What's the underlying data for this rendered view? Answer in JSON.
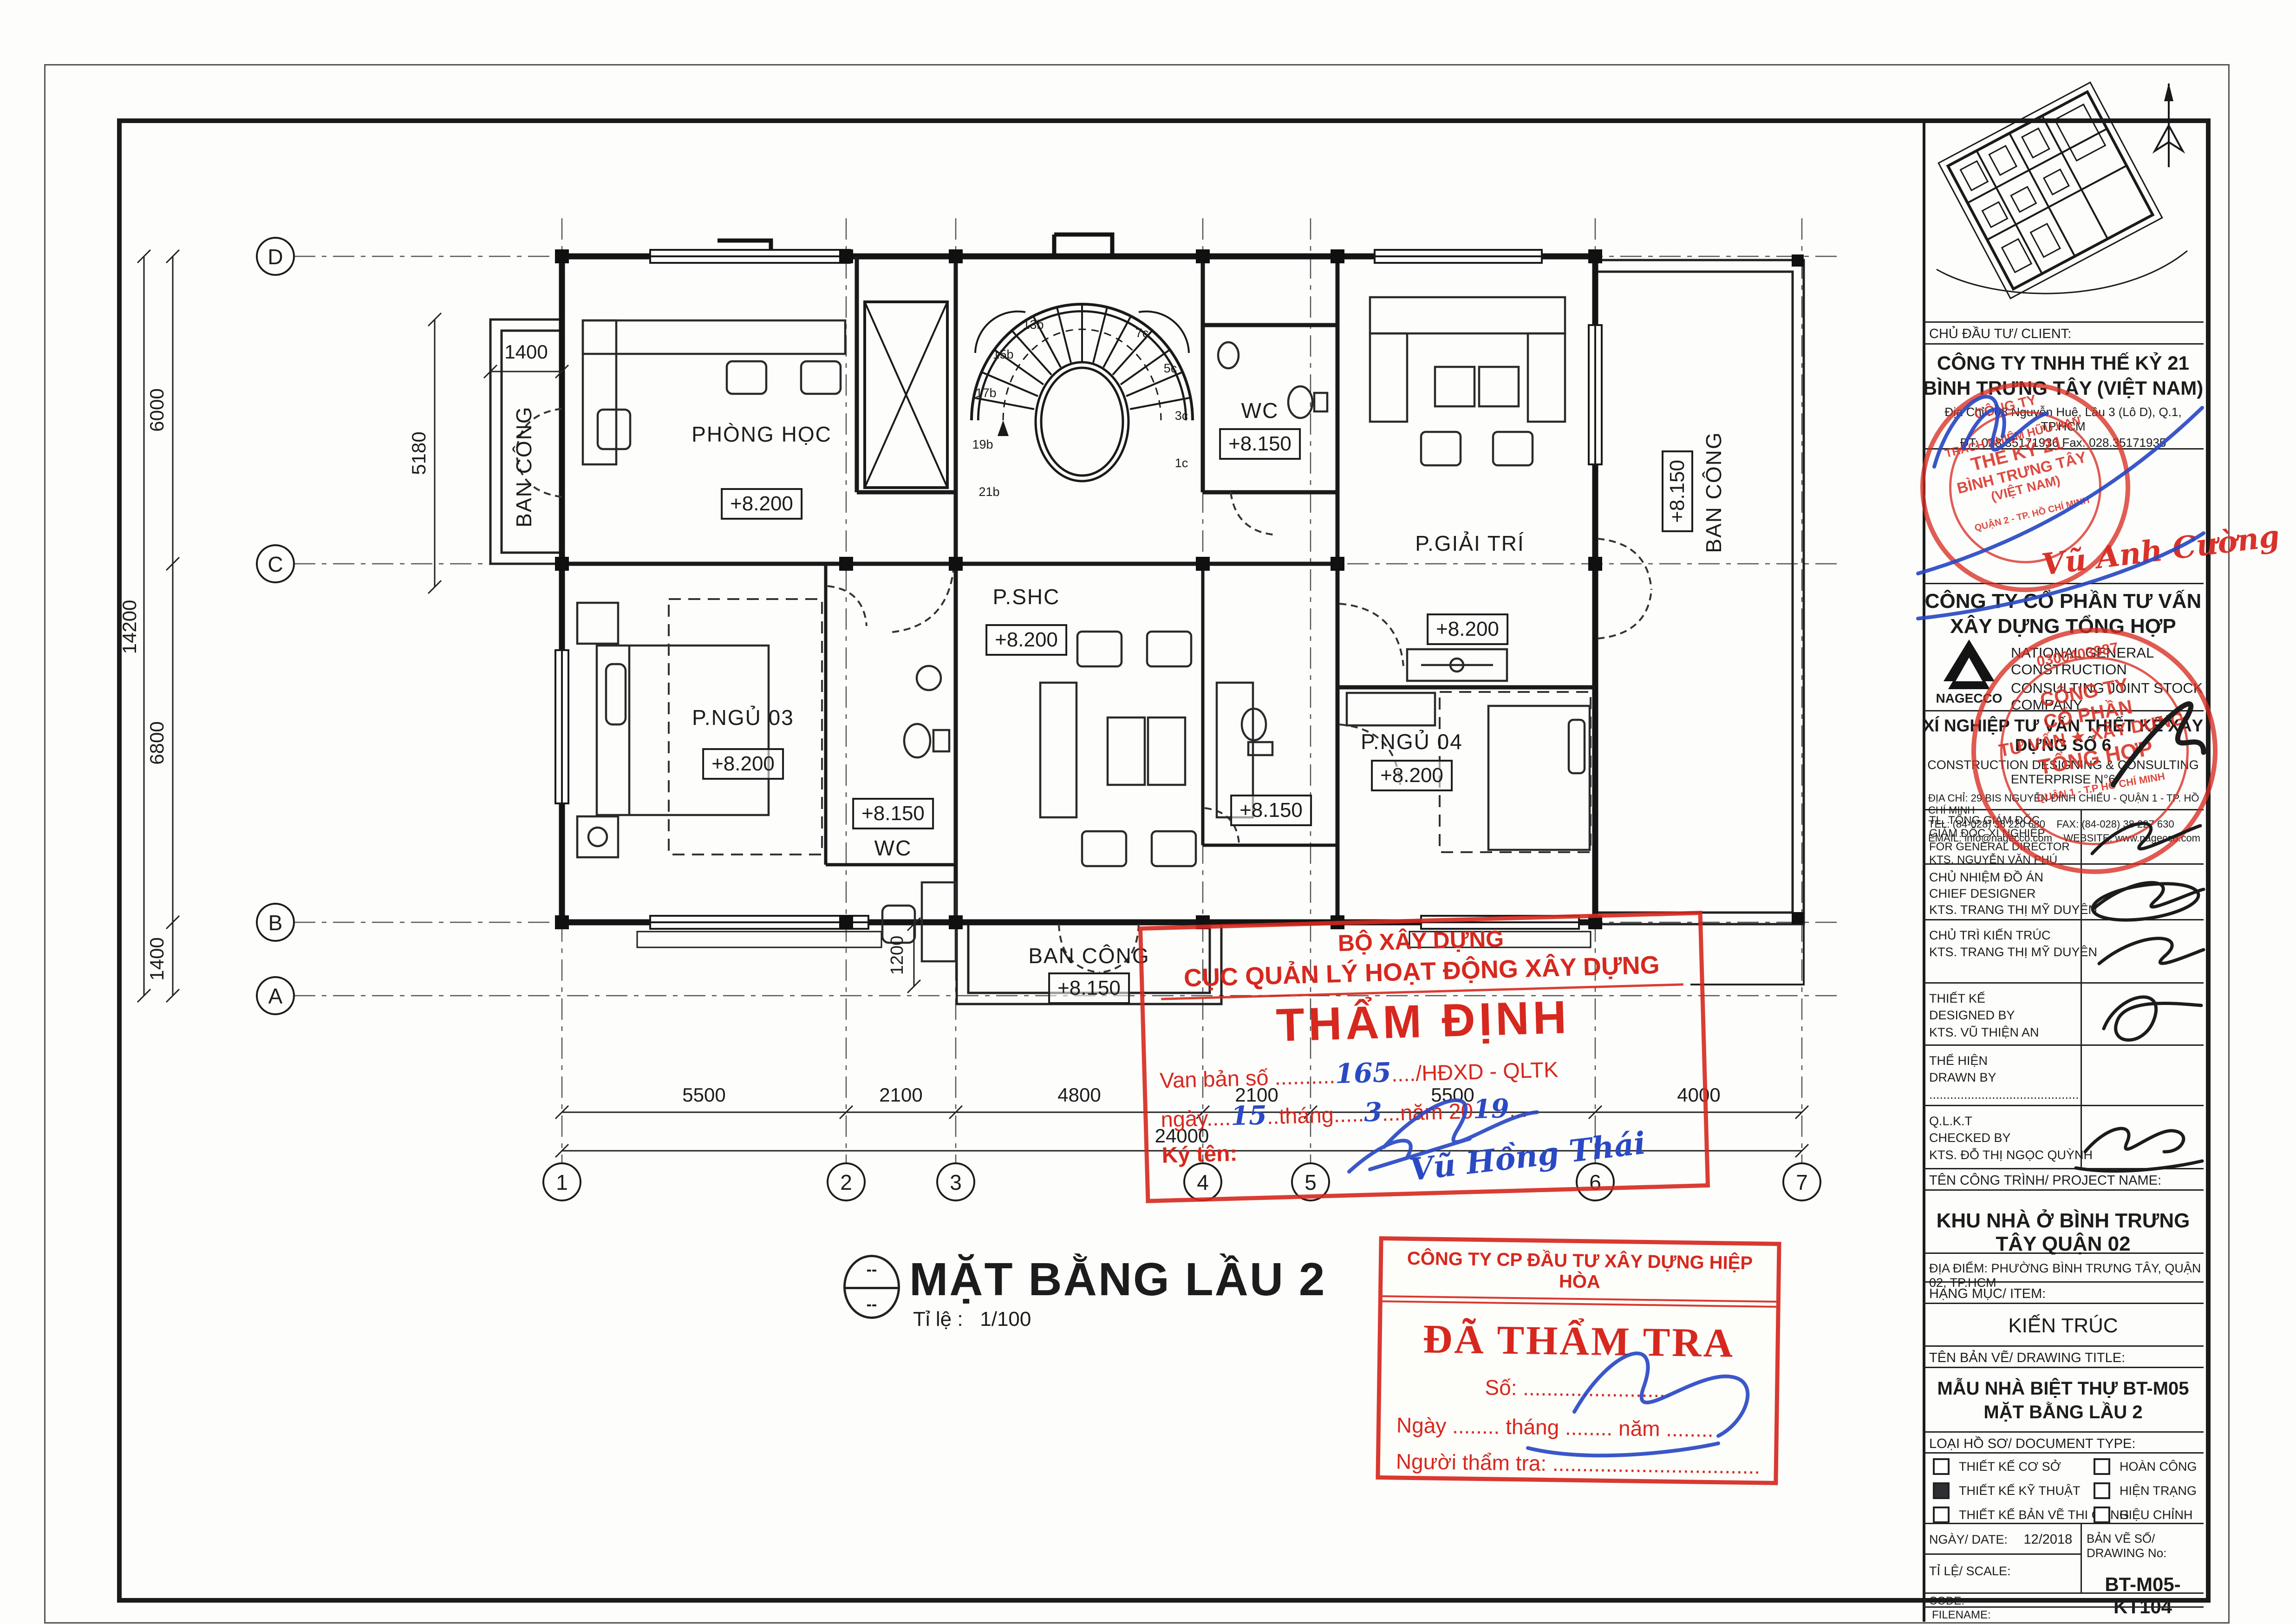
{
  "plan": {
    "title": "MẶT BẰNG LẦU 2",
    "scale_label": "Tỉ lệ :",
    "scale_value": "1/100",
    "fig_dash": "--",
    "grid_cols": [
      "1",
      "2",
      "3",
      "4",
      "5",
      "6",
      "7"
    ],
    "grid_rows": [
      "D",
      "C",
      "B",
      "A"
    ],
    "dims_bottom": [
      "5500",
      "2100",
      "4800",
      "2100",
      "5500",
      "4000"
    ],
    "dim_total_bottom": "24000",
    "dims_left": [
      "6000",
      "6800",
      "1400"
    ],
    "dim_total_left": "14200",
    "dim_balcony_w": "1400",
    "dim_balcony_h": "5180",
    "dim_porch": "1200",
    "rooms": {
      "phong_hoc": {
        "name": "PHÒNG HỌC",
        "level": "+8.200"
      },
      "giai_tri": {
        "name": "P.GIẢI TRÍ",
        "level": "+8.200"
      },
      "shc": {
        "name": "P.SHC",
        "level": "+8.200"
      },
      "ngu03": {
        "name": "P.NGỦ 03",
        "level": "+8.200"
      },
      "ngu04": {
        "name": "P.NGỦ 04",
        "level": "+8.200"
      },
      "wc_top": {
        "name": "WC",
        "level": "+8.150"
      },
      "wc_ngu03": {
        "name": "WC",
        "level": "+8.150"
      },
      "wc_ngu04": {
        "level": "+8.150"
      },
      "bc_left": {
        "name": "BAN CÔNG"
      },
      "bc_right": {
        "name": "BAN CÔNG",
        "level": "+8.150"
      },
      "bc_bottom": {
        "name": "BAN CÔNG",
        "level": "+8.150"
      }
    },
    "stair_labels": [
      "13b",
      "15b",
      "17b",
      "19b",
      "21b",
      "7c",
      "5c",
      "3c",
      "1c"
    ]
  },
  "stamps": {
    "tham_dinh": {
      "line1": "BỘ XÂY DỰNG",
      "line2": "CỤC QUẢN LÝ HOẠT ĐỘNG XÂY DỰNG",
      "title": "THẨM ĐỊNH",
      "doc_pre": "Van bản số ..........",
      "doc_no": "165",
      "doc_post": "..../HĐXD - QLTK",
      "date_pre": "ngày....",
      "date_day": "15",
      "date_mid": "..tháng.....",
      "date_month": "3",
      "date_post": "...năm 20",
      "date_year": "19",
      "date_end": "...",
      "sign_label": "Ký tên:",
      "signature": "Vũ Hồng Thái"
    },
    "da_tham_tra": {
      "company": "CÔNG TY CP ĐẦU TƯ XÂY DỰNG HIỆP HÒA",
      "title": "ĐÃ THẨM TRA",
      "so": "Số: .........................",
      "ngay": "Ngày ........ tháng ........ năm ........",
      "nguoi": "Người thẩm tra: ..................................."
    }
  },
  "titleblock": {
    "client_label": "CHỦ ĐẦU TƯ/ CLIENT:",
    "client_name1": "CÔNG TY TNHH THẾ KỶ 21",
    "client_name2": "BÌNH TRƯNG TÂY (VIỆT NAM)",
    "client_addr": "Địa Chỉ : 08 Nguyễn Huệ, Lầu 3 (Lô D), Q.1, TP.HCM",
    "client_tel": "ĐT: 028.35171936    Fax: 028.35171935",
    "sig_red": "Vũ Anh Cường",
    "consultant1": "CÔNG TY CỔ PHẦN TƯ VẤN",
    "consultant2": "XÂY DỰNG TỔNG HỢP",
    "consultant_en1": "NATIONAL GENERAL CONSTRUCTION",
    "consultant_en2": "CONSULTING JOINT STOCK COMPANY",
    "logo": "NAGECCO",
    "enterprise": "XÍ NGHIỆP TƯ VẤN THIẾT KẾ XÂY DỰNG SỐ 6",
    "enterprise_en": "CONSTRUCTION DESIGNING & CONSULTING ENTERPRISE N°6",
    "addr": "ĐỊA CHỈ: 29 BIS NGUYỄN ĐÌNH CHIỂU - QUẬN 1 - TP. HỒ CHÍ MINH",
    "tel": "TEL: (84-028) 38 220 680",
    "fax": "FAX: (84-028) 38 227 630",
    "email": "EMAIL: info@nagecco.com",
    "web": "WEBSITE: www.nagecco.com",
    "rows": [
      {
        "l1": "TL. TỔNG GIÁM ĐỐC",
        "l2": "GIÁM ĐỐC XÍ NGHIỆP",
        "l3": "FOR GENERAL DIRECTOR",
        "l4": "KTS. NGUYỄN VĂN PHÚ"
      },
      {
        "l1": "CHỦ NHIỆM ĐỒ ÁN",
        "l2": "CHIEF DESIGNER",
        "l3": "KTS. TRANG THỊ MỸ DUYÊN"
      },
      {
        "l1": "CHỦ TRÌ KIẾN TRÚC",
        "l2": "CHIEF ARCHITECT",
        "l3": "KTS. TRANG THỊ MỸ DUYÊN"
      },
      {
        "l1": "THIẾT KẾ",
        "l2": "DESIGNED BY",
        "l3": "KTS. VŨ THIỆN AN"
      },
      {
        "l1": "THỂ HIỆN",
        "l2": "DRAWN BY",
        "l3": "..........................................."
      },
      {
        "l1": "Q.L.K.T",
        "l2": "CHECKED BY",
        "l3": "KTS. ĐỖ THỊ NGỌC QUỲNH"
      }
    ],
    "project_label": "TÊN CÔNG TRÌNH/ PROJECT NAME:",
    "project_name": "KHU NHÀ Ở BÌNH TRƯNG TÂY QUẬN 02",
    "location": "ĐỊA ĐIỂM:  PHƯỜNG BÌNH TRƯNG TÂY, QUẬN 02, TP.HCM",
    "item_label": "HẠNG MỤC/ ITEM:",
    "item_value": "KIẾN TRÚC",
    "title_label": "TÊN BẢN VẼ/ DRAWING TITLE:",
    "title1": "MẪU NHÀ BIỆT THỰ BT-M05",
    "title2": "MẶT BẰNG LẦU 2",
    "doc_label": "LOẠI HỒ SƠ/ DOCUMENT TYPE:",
    "checks_left": [
      {
        "label": "THIẾT KẾ CƠ SỞ",
        "checked": false
      },
      {
        "label": "THIẾT KẾ KỸ THUẬT",
        "checked": true
      },
      {
        "label": "THIẾT KẾ  BẢN VẼ THI CÔNG",
        "checked": false
      }
    ],
    "checks_right": [
      {
        "label": "HOÀN CÔNG",
        "checked": false
      },
      {
        "label": "HIỆN TRẠNG",
        "checked": false
      },
      {
        "label": "HIỆU CHỈNH",
        "checked": false
      }
    ],
    "date_label": "NGÀY/ DATE:",
    "date_value": "12/2018",
    "no_label": "BẢN VẼ SỐ/ DRAWING No:",
    "no_value": "BT-M05-KT104",
    "scale_label": "TỈ LỆ/ SCALE:",
    "code_label": "CODE:",
    "filename_label": "FILENAME:",
    "client_stamp": [
      "CÔNG TY",
      "TRÁCH NHIỆM HỮU HẠN",
      "THẾ KỶ 21",
      "BÌNH TRƯNG TÂY",
      "(VIỆT NAM)",
      "QUẬN 2 - TP. HỒ CHÍ MINH"
    ],
    "company_stamp": [
      "0300403987",
      "CÔNG TY",
      "CỔ PHẦN",
      "TƯ VẤN ★ XÂY DỰNG",
      "TỔNG HỢP",
      "QUẬN 1 - T.P HỒ CHÍ MINH"
    ]
  }
}
